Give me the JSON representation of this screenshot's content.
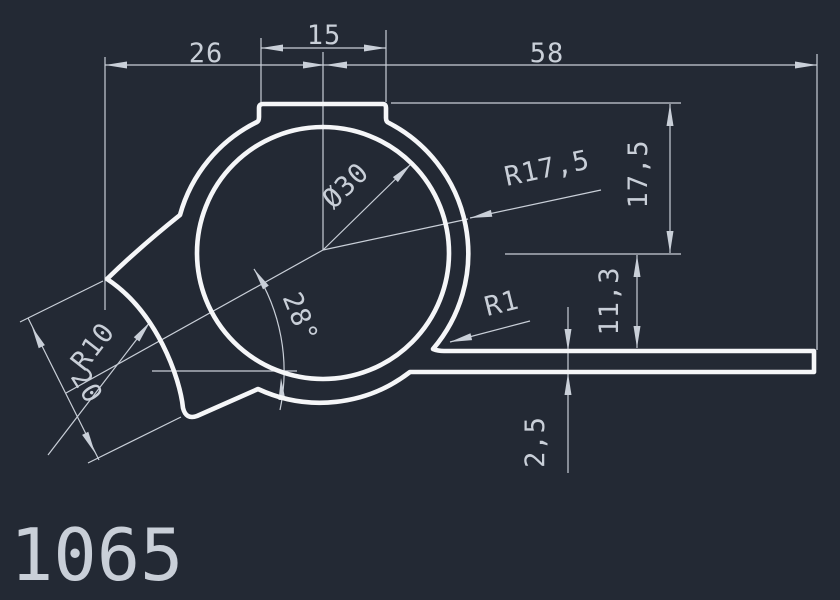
{
  "title": {
    "part_number": "1065"
  },
  "colors": {
    "background": "#232934",
    "profile_line": "#f5f6f8",
    "dimension_line": "#c9cfd8"
  },
  "dimensions": {
    "width_left": "26",
    "tab_width": "15",
    "width_right": "58",
    "height_top": "17,5",
    "height_leg": "11,3",
    "leg_thickness": "2,5",
    "claw_width": "20",
    "claw_angle": "28°",
    "outer_radius": "R17,5",
    "bore_diameter": "Ø30",
    "valley_radius": "R10",
    "fillet_radius": "R1"
  }
}
